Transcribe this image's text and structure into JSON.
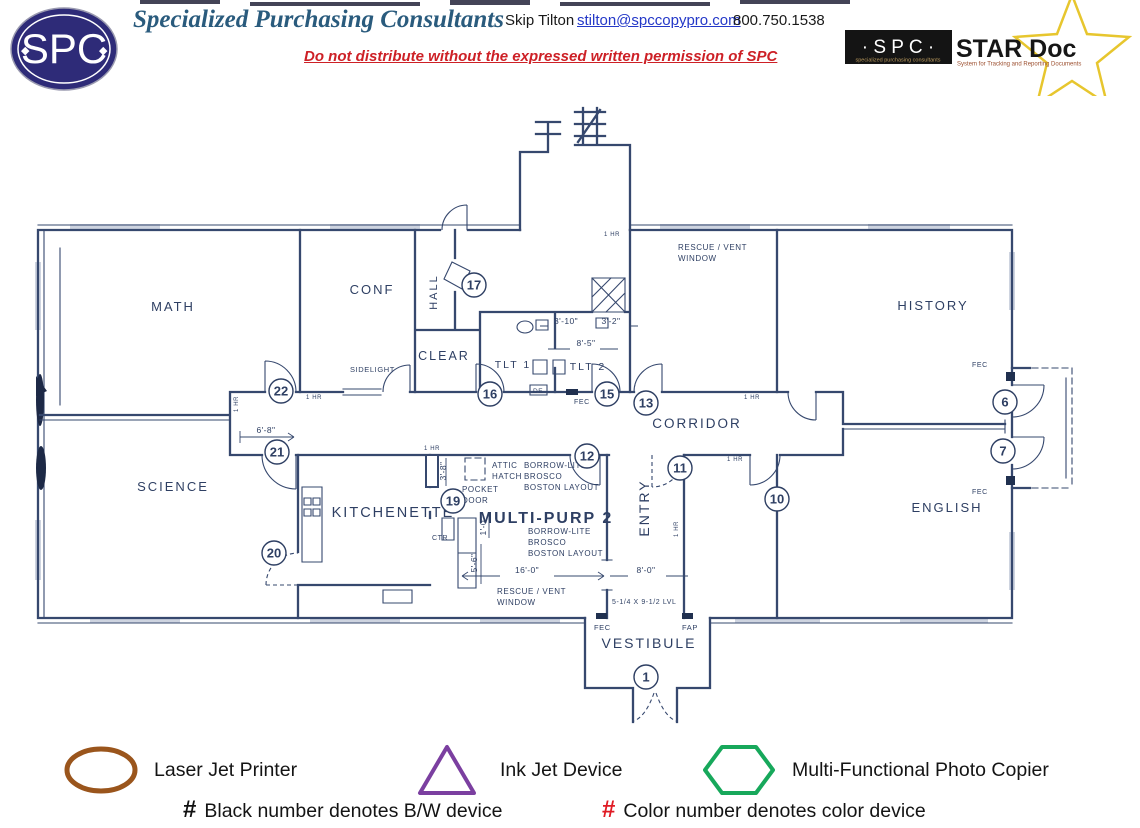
{
  "header": {
    "logo": {
      "text": "SPC"
    },
    "company": "Specialized Purchasing Consultants",
    "contact_name": "Skip Tilton",
    "contact_email": "stilton@spccopypro.com",
    "contact_phone": "800.750.1538",
    "distribution_notice": "Do not distribute without the expressed written permission of SPC",
    "stardoc": {
      "spc": "· S P C ·",
      "spc_sub": "specialized purchasing consultants",
      "name": "STAR Doc",
      "tagline": "System for Tracking and Reporting Documents",
      "star_color": "#e7c62e"
    }
  },
  "floor_plan": {
    "colors": {
      "line": "#36486e",
      "text": "#2e3f63"
    },
    "rooms": [
      {
        "label": "MATH",
        "x": 173,
        "y": 311,
        "size": 13
      },
      {
        "label": "CONF",
        "x": 372,
        "y": 294,
        "size": 13
      },
      {
        "label": "HALL",
        "x": 437,
        "y": 292,
        "size": 11,
        "rotate": -90
      },
      {
        "label": "CLEAR",
        "x": 444,
        "y": 360,
        "size": 12.5
      },
      {
        "label": "TLT 1",
        "x": 513,
        "y": 368,
        "size": 10.5
      },
      {
        "label": "TLT 2",
        "x": 588,
        "y": 370,
        "size": 10.5
      },
      {
        "label": "CORRIDOR",
        "x": 697,
        "y": 428,
        "size": 13.5
      },
      {
        "label": "HISTORY",
        "x": 933,
        "y": 310,
        "size": 13
      },
      {
        "label": "SCIENCE",
        "x": 173,
        "y": 491,
        "size": 13
      },
      {
        "label": "KITCHENETTE",
        "x": 393,
        "y": 517,
        "size": 14.5
      },
      {
        "label": "MULTI-PURP 2",
        "x": 546,
        "y": 523,
        "size": 16,
        "bold": true
      },
      {
        "label": "ENTRY",
        "x": 649,
        "y": 508,
        "size": 14,
        "rotate": -90
      },
      {
        "label": "ENGLISH",
        "x": 947,
        "y": 512,
        "size": 13
      },
      {
        "label": "VESTIBULE",
        "x": 649,
        "y": 648,
        "size": 14
      }
    ],
    "devices": [
      {
        "number": "1",
        "x": 646,
        "y": 677
      },
      {
        "number": "6",
        "x": 1005,
        "y": 402
      },
      {
        "number": "7",
        "x": 1003,
        "y": 451
      },
      {
        "number": "10",
        "x": 777,
        "y": 499
      },
      {
        "number": "11",
        "x": 680,
        "y": 468
      },
      {
        "number": "12",
        "x": 587,
        "y": 456
      },
      {
        "number": "13",
        "x": 646,
        "y": 403
      },
      {
        "number": "15",
        "x": 607,
        "y": 394
      },
      {
        "number": "16",
        "x": 490,
        "y": 394
      },
      {
        "number": "17",
        "x": 474,
        "y": 285
      },
      {
        "number": "19",
        "x": 453,
        "y": 501
      },
      {
        "number": "20",
        "x": 274,
        "y": 553
      },
      {
        "number": "21",
        "x": 277,
        "y": 452
      },
      {
        "number": "22",
        "x": 281,
        "y": 391
      }
    ],
    "dimensions": [
      {
        "text": "6'-8\"",
        "x": 266,
        "y": 433
      },
      {
        "text": "3'-10\"",
        "x": 566,
        "y": 324
      },
      {
        "text": "3'-2\"",
        "x": 611,
        "y": 324
      },
      {
        "text": "8'-5\"",
        "x": 586,
        "y": 346
      },
      {
        "text": "3'-8\"",
        "x": 446,
        "y": 471,
        "rotate": -90
      },
      {
        "text": "1'-0\"",
        "x": 486,
        "y": 526,
        "rotate": -90
      },
      {
        "text": "5'-6\"",
        "x": 477,
        "y": 563,
        "rotate": -90
      },
      {
        "text": "16'-0\"",
        "x": 527,
        "y": 573
      },
      {
        "text": "8'-0\"",
        "x": 646,
        "y": 573
      }
    ],
    "annotations": [
      {
        "text": "RESCUE / VENT",
        "x": 678,
        "y": 250
      },
      {
        "text": "WINDOW",
        "x": 678,
        "y": 261
      },
      {
        "text": "SIDELIGHT",
        "x": 350,
        "y": 372,
        "size": 7.5
      },
      {
        "text": "ATTIC",
        "x": 492,
        "y": 468
      },
      {
        "text": "HATCH",
        "x": 492,
        "y": 479
      },
      {
        "text": "POCKET",
        "x": 462,
        "y": 492
      },
      {
        "text": "DOOR",
        "x": 462,
        "y": 503
      },
      {
        "text": "BORROW-LITE",
        "x": 524,
        "y": 468
      },
      {
        "text": "BROSCO",
        "x": 524,
        "y": 479
      },
      {
        "text": "BOSTON LAYOUT",
        "x": 524,
        "y": 490
      },
      {
        "text": "BORROW-LITE",
        "x": 528,
        "y": 534
      },
      {
        "text": "BROSCO",
        "x": 528,
        "y": 545
      },
      {
        "text": "BOSTON LAYOUT",
        "x": 528,
        "y": 556
      },
      {
        "text": "RESCUE / VENT",
        "x": 497,
        "y": 594
      },
      {
        "text": "WINDOW",
        "x": 497,
        "y": 605
      },
      {
        "text": "5-1/4 X 9-1/2 LVL",
        "x": 612,
        "y": 604,
        "size": 7
      },
      {
        "text": "CTR",
        "x": 432,
        "y": 540,
        "size": 7
      },
      {
        "text": "DE",
        "x": 533,
        "y": 393,
        "size": 6.5
      },
      {
        "text": "FEC",
        "x": 574,
        "y": 404,
        "size": 7
      },
      {
        "text": "FEC",
        "x": 972,
        "y": 367,
        "size": 7
      },
      {
        "text": "FEC",
        "x": 972,
        "y": 494,
        "size": 7
      },
      {
        "text": "FEC",
        "x": 594,
        "y": 630,
        "size": 7.5
      },
      {
        "text": "FAP",
        "x": 682,
        "y": 630,
        "size": 7.5
      },
      {
        "text": "1 HR",
        "x": 306,
        "y": 399,
        "size": 6
      },
      {
        "text": "1 HR",
        "x": 424,
        "y": 450,
        "size": 6
      },
      {
        "text": "1 HR",
        "x": 744,
        "y": 399,
        "size": 6
      },
      {
        "text": "1 HR",
        "x": 727,
        "y": 461,
        "size": 6
      },
      {
        "text": "1 HR",
        "x": 604,
        "y": 236,
        "size": 6
      },
      {
        "text": "1 HR",
        "x": 238,
        "y": 412,
        "size": 6,
        "rotate": -90
      },
      {
        "text": "1 HR",
        "x": 678,
        "y": 537,
        "size": 6,
        "rotate": -90
      }
    ]
  },
  "legend": {
    "items": [
      {
        "shape": "ellipse",
        "color": "#9a551c",
        "label": "Laser Jet Printer"
      },
      {
        "shape": "triangle",
        "color": "#7b3fa0",
        "label": "Ink Jet Device"
      },
      {
        "shape": "hexagon",
        "color": "#17a85b",
        "label": "Multi-Functional Photo Copier"
      }
    ],
    "notes": [
      {
        "symbol": "#",
        "symbol_color": "#111111",
        "text": "Black number denotes B/W device"
      },
      {
        "symbol": "#",
        "symbol_color": "#e01b24",
        "text": "Color number denotes color device"
      }
    ]
  }
}
